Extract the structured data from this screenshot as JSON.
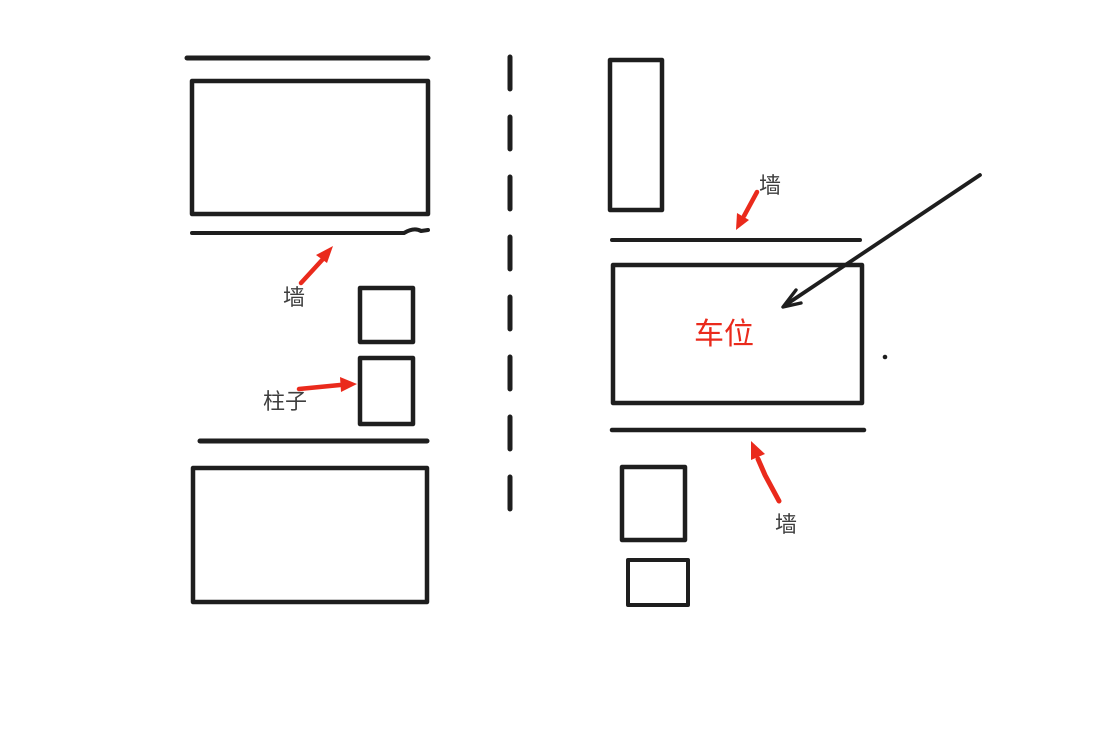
{
  "labels": {
    "wall_left": "墙",
    "pillar": "柱子",
    "wall_top_right": "墙",
    "wall_bottom_right": "墙",
    "parking_space": "车位"
  },
  "colors": {
    "line": "#1e1e1e",
    "label": "#3e3e3e",
    "red": "#ea2a1c"
  }
}
